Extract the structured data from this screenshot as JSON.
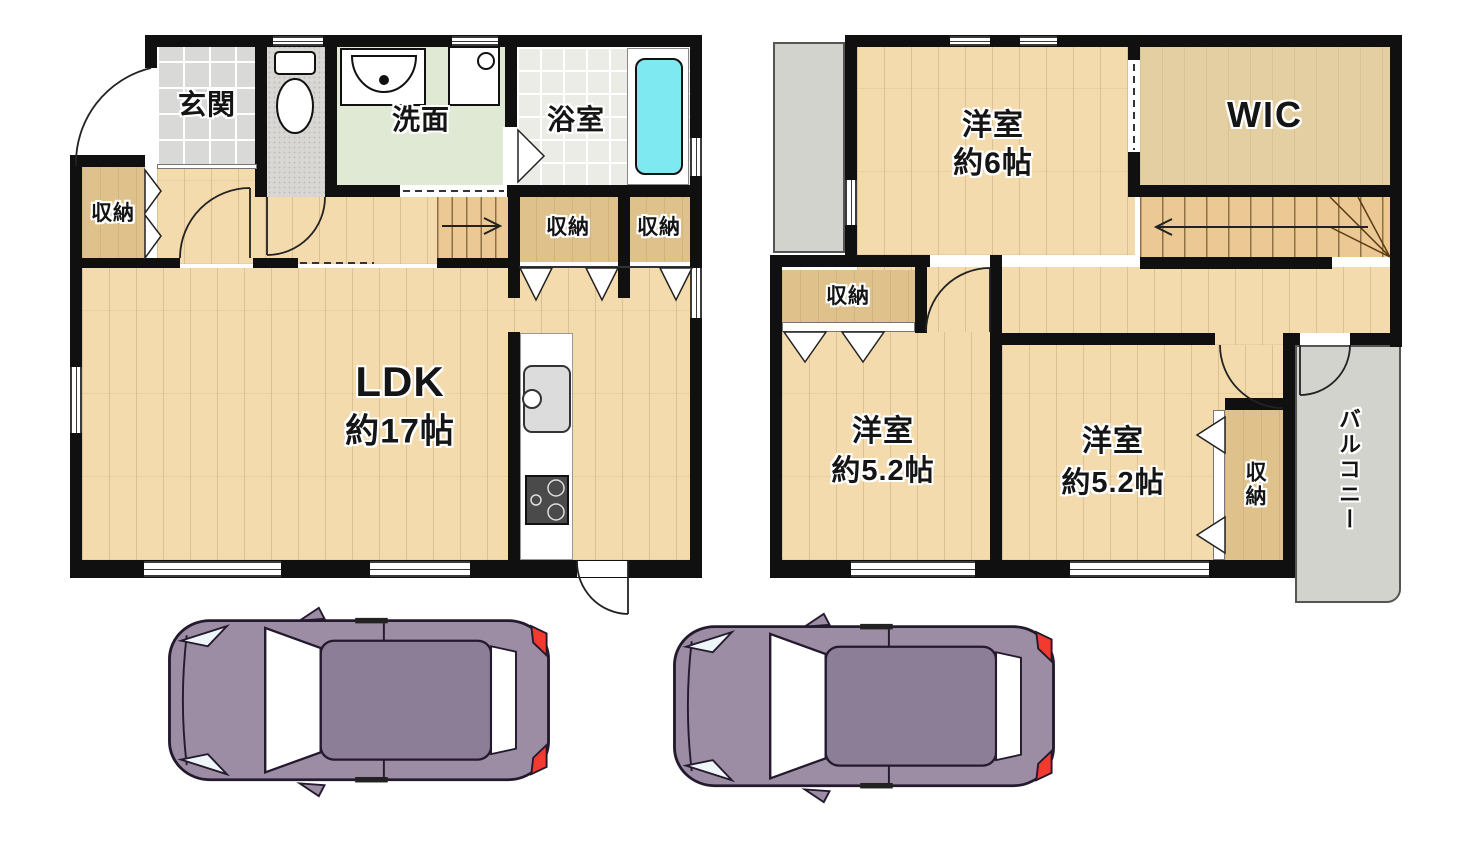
{
  "floor1": {
    "genkan": "玄関",
    "closet_left": "収納",
    "washroom": "洗面",
    "bathroom": "浴室",
    "closet_a": "収納",
    "closet_b": "収納",
    "ldk_name": "LDK",
    "ldk_size": "約17帖"
  },
  "floor2": {
    "bedroom1_name": "洋室",
    "bedroom1_size": "約6帖",
    "wic": "WIC",
    "hall_closet": "収納",
    "bedroom2_name": "洋室",
    "bedroom2_size": "約5.2帖",
    "bedroom3_name": "洋室",
    "bedroom3_size": "約5.2帖",
    "closet_right": "収納",
    "balcony": "バルコニー"
  },
  "colors": {
    "wall": "#101010",
    "wood_floor": "#f3dbae",
    "closet": "#dfc18c",
    "stairs": "#ecc894",
    "genkan_tile": "#d9d9d7",
    "washroom_floor": "#dfe9d4",
    "bathroom_floor": "#ececе7",
    "bathtub": "#7fe9f2",
    "outdoor_gray": "#d2d3cd",
    "car_body": "#9c8ca4",
    "car_roof": "#8d7e97",
    "car_tail": "#f23b2e"
  },
  "icons": {
    "toilet-icon": "toilet top view shape",
    "bathroom-sink-icon": "half-round basin",
    "washing-machine-icon": "square with drum circle",
    "bathtub-icon": "rounded rectangle tub",
    "kitchen-sink-icon": "counter sink with faucet",
    "stove-icon": "two-burner cooktop",
    "stairs-up-arrow-icon": "→",
    "stairs-down-arrow-icon": "←",
    "door-arc-icon": "quarter-circle swing",
    "folding-door-icon": "triangle",
    "car-top-view-icon": "vehicle seen from above"
  }
}
